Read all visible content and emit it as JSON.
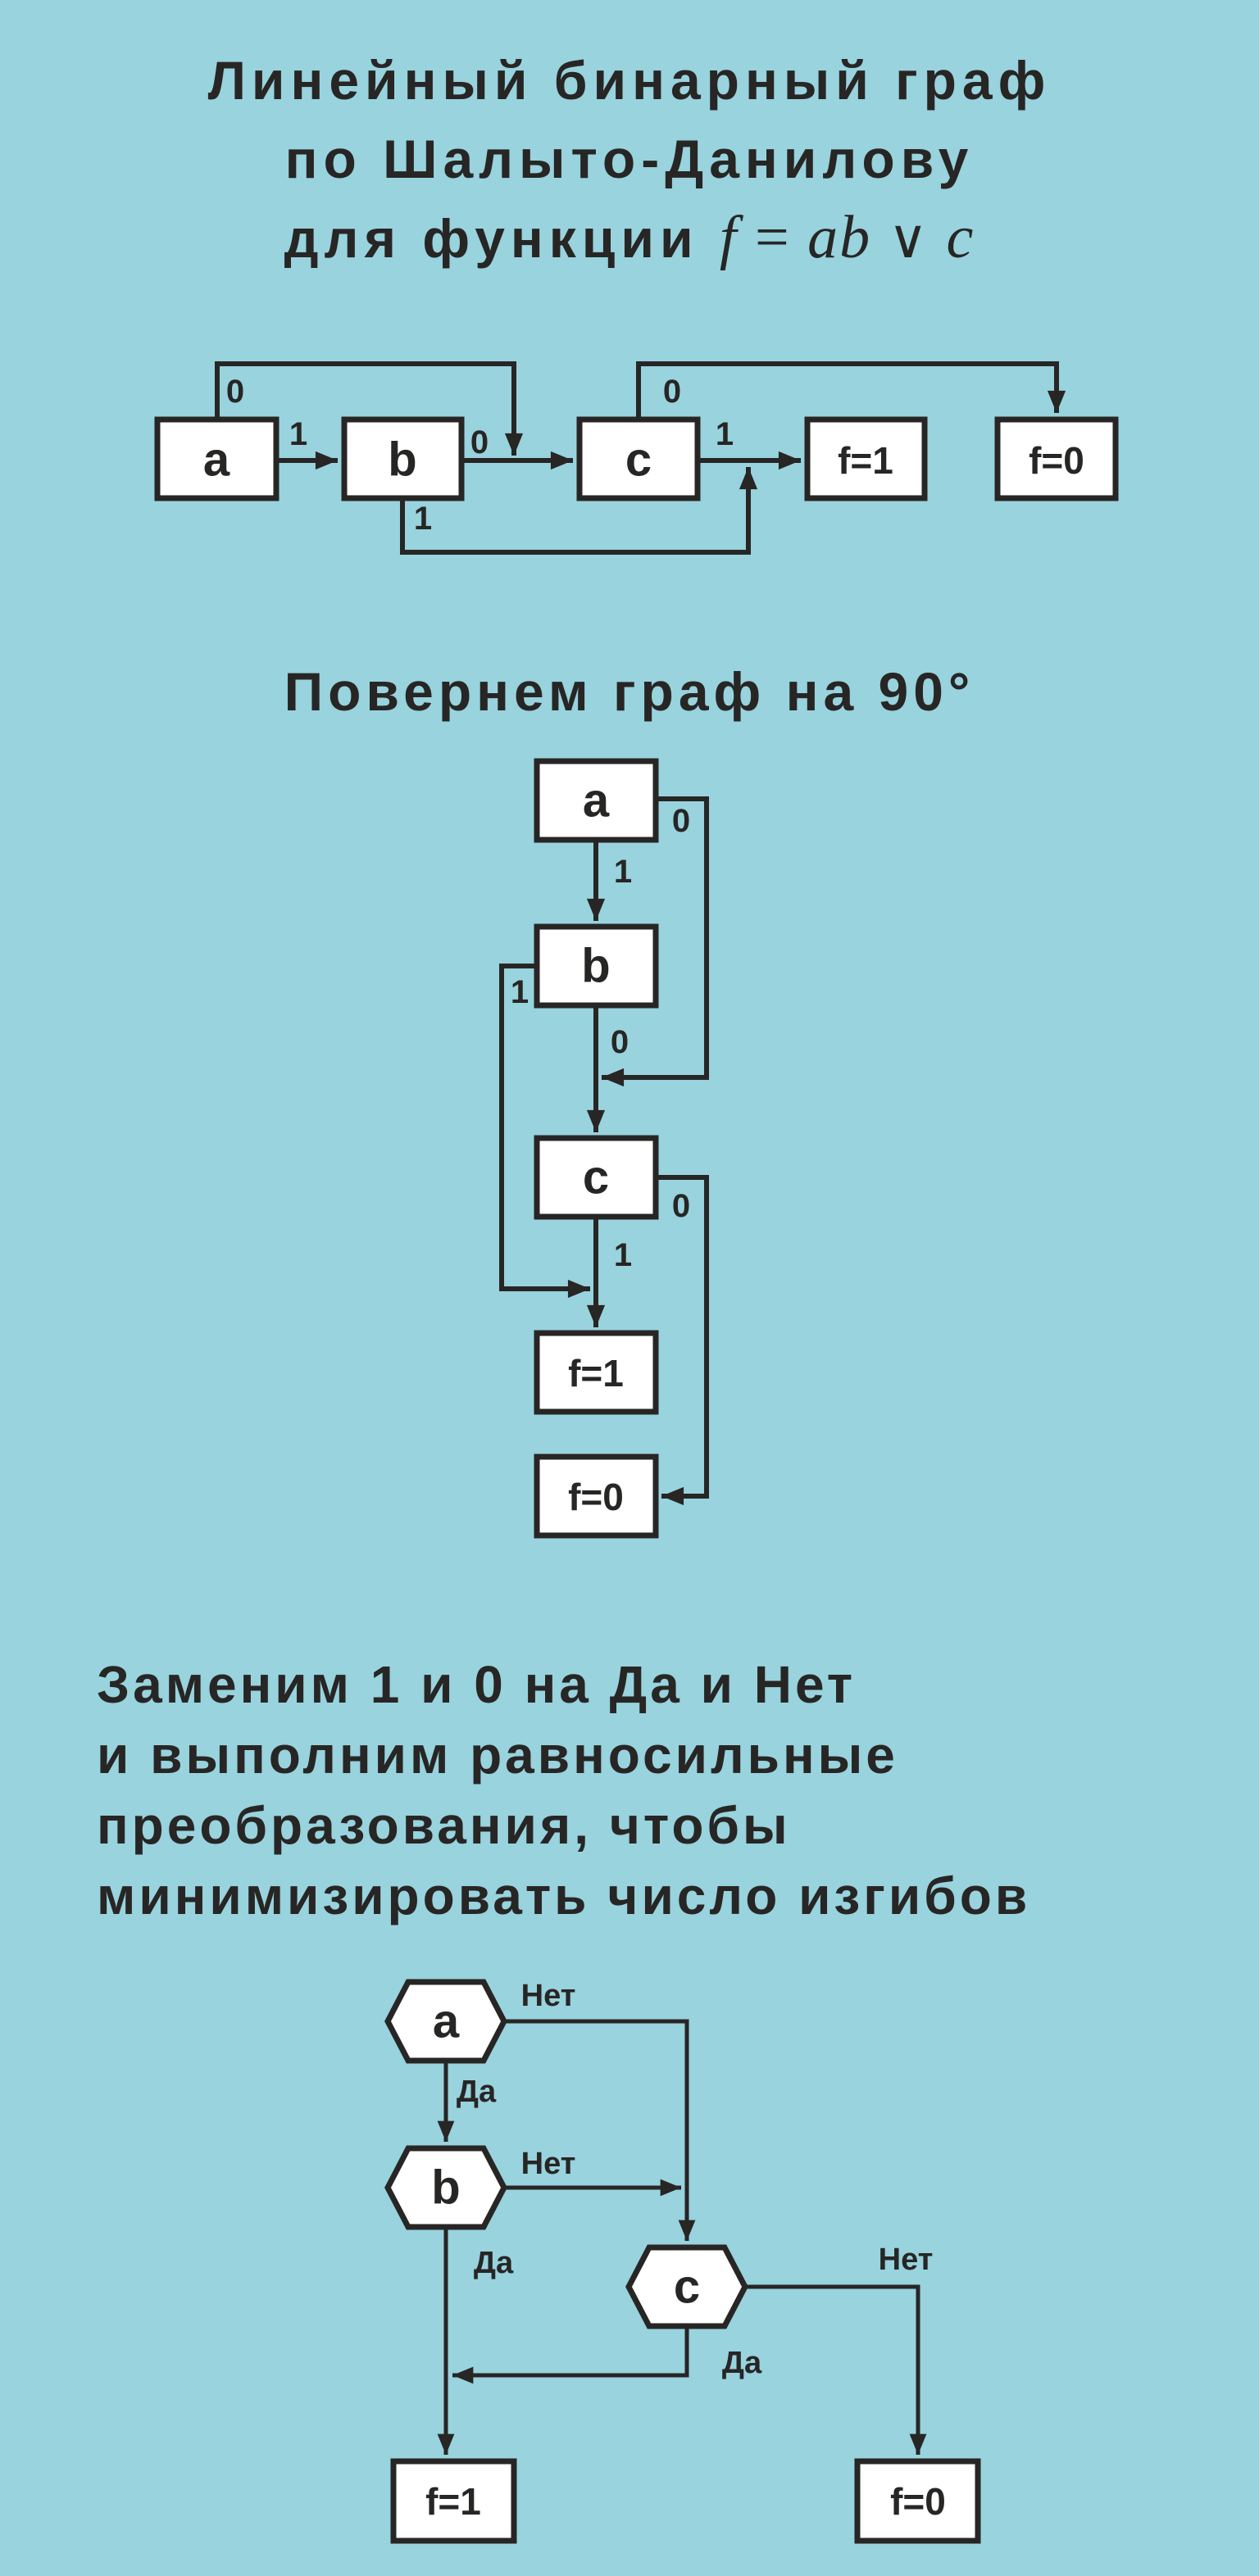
{
  "page": {
    "bg_color": "#98d3de",
    "ink_color": "#272625",
    "node_fill": "#ffffff"
  },
  "title": {
    "line1": "Линейный бинарный граф",
    "line2": "по Шалыто-Данилову",
    "line3_text": "для функции",
    "formula": {
      "f": "f",
      "eq": "=",
      "ab": "ab",
      "or": "∨",
      "c": "c"
    }
  },
  "section_rotate": {
    "heading": "Повернем граф на 90°"
  },
  "section_replace": {
    "lines": [
      "Заменим 1 и 0 на Да и Нет",
      "и выполним равносильные",
      "преобразования, чтобы",
      "минимизировать число изгибов"
    ]
  },
  "fc1": {
    "nodes": {
      "a": "a",
      "b": "b",
      "c": "c",
      "f1": "f=1",
      "f0": "f=0"
    },
    "labels": {
      "a0": "0",
      "a1": "1",
      "b0": "0",
      "b1": "1",
      "c0": "0",
      "c1": "1"
    },
    "edges": [
      {
        "from": "a",
        "label": "1",
        "to": "b"
      },
      {
        "from": "a",
        "label": "0",
        "to": "junction on edge b→c"
      },
      {
        "from": "b",
        "label": "0",
        "to": "c"
      },
      {
        "from": "b",
        "label": "1",
        "to": "junction on edge c→f=1"
      },
      {
        "from": "c",
        "label": "1",
        "to": "f=1"
      },
      {
        "from": "c",
        "label": "0",
        "to": "f=0"
      }
    ]
  },
  "fc2": {
    "nodes": {
      "a": "a",
      "b": "b",
      "c": "c",
      "f1": "f=1",
      "f0": "f=0"
    },
    "labels": {
      "a0": "0",
      "a1": "1",
      "b0": "0",
      "b1": "1",
      "c0": "0",
      "c1": "1"
    },
    "edges": [
      {
        "from": "a",
        "label": "1",
        "to": "b"
      },
      {
        "from": "a",
        "label": "0",
        "to": "junction on edge b→c"
      },
      {
        "from": "b",
        "label": "0",
        "to": "c"
      },
      {
        "from": "b",
        "label": "1",
        "to": "junction on edge c→f=1"
      },
      {
        "from": "c",
        "label": "1",
        "to": "f=1"
      },
      {
        "from": "c",
        "label": "0",
        "to": "f=0"
      }
    ]
  },
  "fc3": {
    "nodes": {
      "a": "a",
      "b": "b",
      "c": "c",
      "f1": "f=1",
      "f0": "f=0"
    },
    "labels": {
      "a_no": "Нет",
      "a_yes": "Да",
      "b_no": "Нет",
      "b_yes": "Да",
      "c_no": "Нет",
      "c_yes": "Да"
    },
    "edges": [
      {
        "from": "a",
        "label": "Да",
        "to": "b"
      },
      {
        "from": "a",
        "label": "Нет",
        "to": "c"
      },
      {
        "from": "b",
        "label": "Нет",
        "to": "junction on edge a→c"
      },
      {
        "from": "b",
        "label": "Да",
        "to": "f=1"
      },
      {
        "from": "c",
        "label": "Да",
        "to": "junction on edge b→f=1"
      },
      {
        "from": "c",
        "label": "Нет",
        "to": "f=0"
      }
    ]
  }
}
